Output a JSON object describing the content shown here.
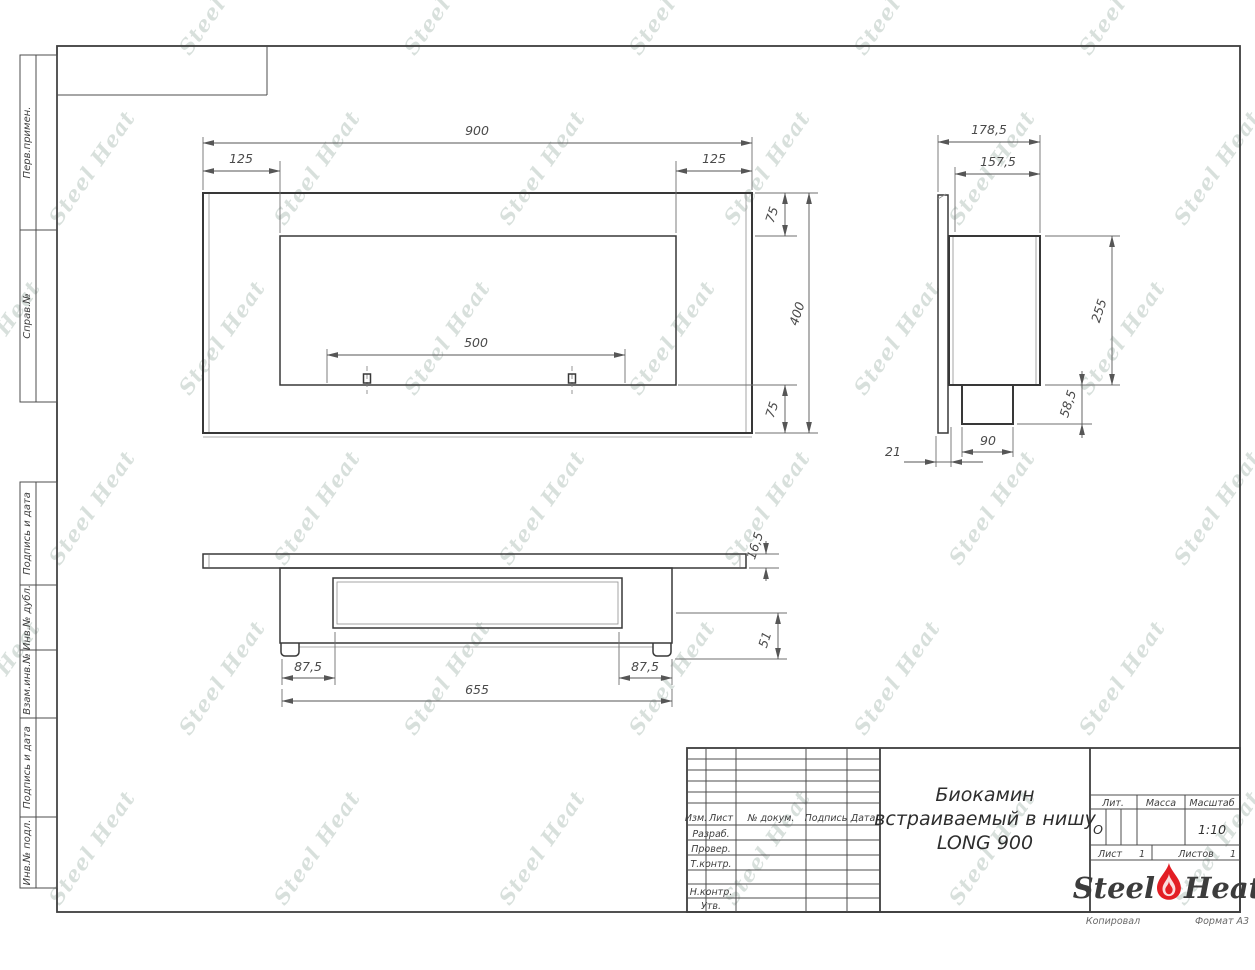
{
  "watermark": {
    "text": "Steel Heat"
  },
  "margin": {
    "perv_primen": "Перв.примен.",
    "sprav_no": "Справ.№",
    "podpis_i_data_top": "Подпись и дата",
    "inv_no_dubl": "Инв.№ дубл.",
    "vzam_inv_no": "Взам.инв.№",
    "podpis_i_data_bottom": "Подпись и дата",
    "inv_no_podl": "Инв.№ подл."
  },
  "views": {
    "front": {
      "overall_width": "900",
      "left_inset": "125",
      "right_inset": "125",
      "top_inset": "75",
      "overall_height": "400",
      "bottom_inset": "75",
      "burner_span": "500"
    },
    "side": {
      "overall_depth": "178,5",
      "body_depth": "157,5",
      "body_height": "255",
      "burner_height": "58,5",
      "burner_depth": "90",
      "panel_offset": "21"
    },
    "bottom": {
      "panel_thickness": "16,5",
      "body_drop": "51",
      "left_inset": "87,5",
      "right_inset": "87,5",
      "body_width": "655"
    }
  },
  "title_block": {
    "revision_header": {
      "izm": "Изм.",
      "list": "Лист",
      "doc": "№ докум.",
      "podpis": "Подпись",
      "data": "Дата"
    },
    "role_rows": {
      "razrab": "Разраб.",
      "prover": "Провер.",
      "tkontr": "Т.контр.",
      "nkontr": "Н.контр.",
      "utv": "Утв."
    },
    "name_line1": "Биокамин",
    "name_line2": "встраиваемый в нишу",
    "name_line3": "LONG 900",
    "lit_label": "Лит.",
    "lit_value": "О",
    "massa_label": "Масса",
    "masshtab_label": "Масштаб",
    "masshtab_value": "1:10",
    "list_label": "Лист",
    "list_value": "1",
    "listov_label": "Листов",
    "listov_value": "1",
    "logo_steel": "Steel",
    "logo_heat": "Heat"
  },
  "footer": {
    "kopiroval": "Копировал",
    "format": "Формат А3"
  },
  "colors": {
    "outline": "#383838",
    "dimension": "#565656",
    "flame_red": "#e31e24",
    "watermark": "#b3c2bb"
  }
}
